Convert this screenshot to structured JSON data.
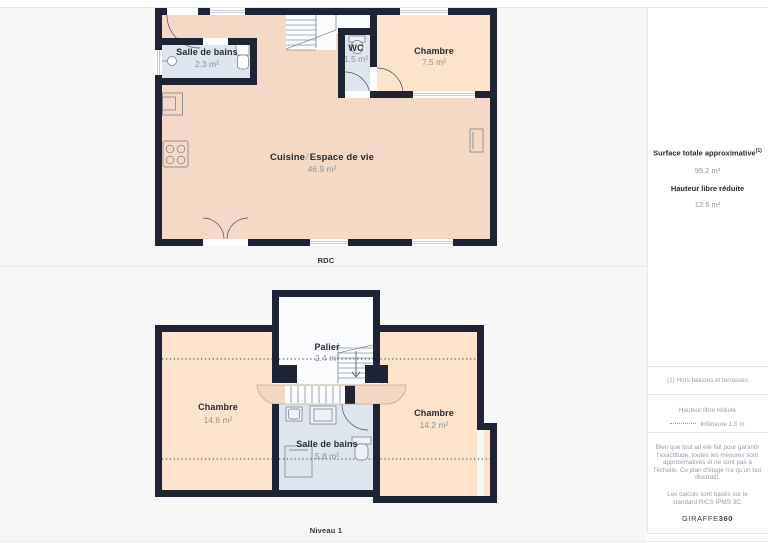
{
  "floors": {
    "rdc": {
      "label": "RDC",
      "rooms": {
        "salle_de_bains": {
          "name": "Salle de bains",
          "area": "2.3 m²"
        },
        "wc": {
          "name": "WC",
          "area": "1.5 m²"
        },
        "chambre": {
          "name": "Chambre",
          "area": "7.5 m²"
        },
        "cuisine": {
          "name_main": "Cuisine",
          "separator": "/",
          "name_secondary": "Espace de vie",
          "area": "46.9 m²"
        }
      }
    },
    "niveau1": {
      "label": "Niveau 1",
      "rooms": {
        "chambre_gauche": {
          "name": "Chambre",
          "area": "14.6 m²"
        },
        "palier": {
          "name": "Palier",
          "area": "2.4 m²"
        },
        "chambre_droite": {
          "name": "Chambre",
          "area": "14.2 m²"
        },
        "salle_de_bains": {
          "name": "Salle de bains",
          "area": "5.8 m²"
        }
      }
    }
  },
  "sidebar": {
    "surface_title": "Surface totale approximative",
    "surface_title_sup": "(1)",
    "surface_value": "95.2 m²",
    "hauteur_title": "Hauteur libre réduite",
    "hauteur_value": "12.6 m²",
    "note_balcons": "(1) Hors balcons et terrasses",
    "legend_hauteur_title": "Hauteur libre réduite",
    "legend_hauteur_value": "Inférieure 1.5 m",
    "disclaimer": "Bien que tout ait été fait pour garantir l'exactitude, toutes les mesures sont approximatives et ne sont pas à l'échelle. Ce plan d'étage n'a qu'un but illustratif.",
    "standard_note": "Les calculs sont basés sur le standard RICS IPMS 3C.",
    "brand_name": "GIRAFFE",
    "brand_suffix": "360"
  },
  "colors": {
    "wall": "#1e2433",
    "room_warm": "#f4dac6",
    "room_warm_light": "#fbe4cb",
    "room_wet": "#dfe5ee",
    "landing_white": "#fbfcfd",
    "band": "#f2d7c1",
    "background": "#f7f7f8"
  }
}
